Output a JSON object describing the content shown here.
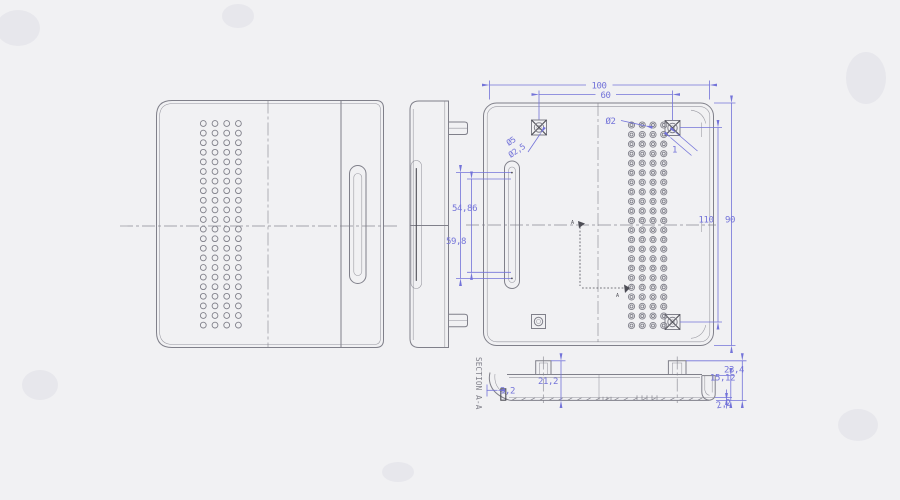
{
  "drawing": {
    "type": "engineering-cad-drawing",
    "views": {
      "front": {
        "description": "front face with ventilation hole grid and side slot"
      },
      "side": {
        "description": "side profile with two snap tabs and slot edge"
      },
      "back": {
        "description": "inside plan view with screw bosses and hole grid"
      },
      "section": {
        "title": "SECTION A-A",
        "marker_top": "A",
        "marker_bottom": "A"
      }
    },
    "labels": {
      "dim_overall_width": "100",
      "dim_boss_spacing_h": "60",
      "dim_overall_height": "110",
      "dim_boss_spacing_v": "90",
      "dia_hole": "Ø2",
      "dia_boss_outer": "Ø5",
      "dia_boss_inner": "Ø2,5",
      "chamfer_callout": "1",
      "dim_slot_inner": "54,86",
      "dim_slot_outer": "59,8",
      "sec_step": "3,2",
      "sec_boss_height": "21,2",
      "sec_total_height": "23,4",
      "sec_wall_height": "15,12",
      "sec_base_thickness": "2,2",
      "section_title": "SECTION A-A",
      "section_marker_top": "A",
      "section_marker_bottom": "A"
    },
    "grids": {
      "front_grid": {
        "cols": 4,
        "rows": 22
      },
      "back_grid": {
        "cols": 4,
        "rows": 22
      }
    },
    "colors": {
      "bg": "#f1f1f3",
      "line": "#80808a",
      "dark": "#4d4d55",
      "dim": "#7373d9"
    }
  }
}
